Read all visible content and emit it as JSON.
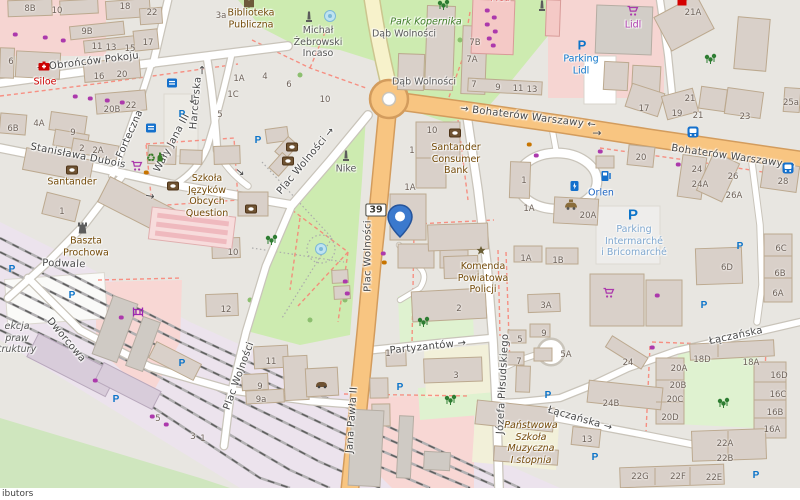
{
  "map": {
    "attribution": "ibutors",
    "shield": {
      "t": "39",
      "x": 376,
      "y": 210
    },
    "marker": {
      "x": 400,
      "y": 238
    },
    "colors": {
      "road_secondary": "#F8C581",
      "road_tertiary": "#F7F2CB",
      "park": "#CDEBB0",
      "grass": "#DFF2D0",
      "retail": "#F6D5D2",
      "railway_land": "#ECE3ED",
      "marker_blue": "#3B79CD",
      "parking_blue": "#0C74C9",
      "shop_purple": "#AC39AC",
      "amenity_brown": "#734A08",
      "school_yellow": "#F2F0D9"
    },
    "streets": [
      {
        "t": "→  Obrońców Pokoju",
        "x": 88,
        "y": 62,
        "r": -7
      },
      {
        "t": "Harcerska",
        "x": 196,
        "y": 103,
        "r": -85
      },
      {
        "t": "Forteczna",
        "x": 130,
        "y": 134,
        "r": -66
      },
      {
        "t": "Wały Jana III",
        "x": 172,
        "y": 143,
        "r": -62
      },
      {
        "t": "Stanisława Dubois",
        "x": 78,
        "y": 156,
        "r": 11
      },
      {
        "t": "Plac Wolności  →",
        "x": 306,
        "y": 161,
        "r": -50
      },
      {
        "t": "Plac Wolności",
        "x": 368,
        "y": 256,
        "r": -90
      },
      {
        "t": "Plac Wolności",
        "x": 239,
        "y": 376,
        "r": -70
      },
      {
        "t": "Jana Pawła II",
        "x": 352,
        "y": 420,
        "r": -86
      },
      {
        "t": "Józefa Piłsudskiego",
        "x": 503,
        "y": 384,
        "r": -87
      },
      {
        "t": "→ Bohaterów Warszawy ←",
        "x": 528,
        "y": 117,
        "r": 7
      },
      {
        "t": "Bohaterów Warszawy →",
        "x": 733,
        "y": 157,
        "r": 8
      },
      {
        "t": "Partyzantów →",
        "x": 428,
        "y": 347,
        "r": -6
      },
      {
        "t": "Łączańska",
        "x": 736,
        "y": 336,
        "r": -12
      },
      {
        "t": "Łączańska →",
        "x": 580,
        "y": 419,
        "r": 16
      },
      {
        "t": "Podwale",
        "x": 64,
        "y": 264,
        "r": 2
      },
      {
        "t": "Dworcowa",
        "x": 66,
        "y": 340,
        "r": 50
      }
    ],
    "pois": [
      {
        "t": "Biblioteka\nPubliczna",
        "x": 251,
        "y": 19,
        "c": "amenity"
      },
      {
        "t": "Michał\nŻebrowski\nIncaso",
        "x": 318,
        "y": 42,
        "c": "gray"
      },
      {
        "t": "Park Kopernika",
        "x": 426,
        "y": 22,
        "c": "park",
        "i": 1
      },
      {
        "t": "Dąb Wolności",
        "x": 404,
        "y": 34,
        "c": "gray"
      },
      {
        "t": "Dąb Wolności",
        "x": 424,
        "y": 82,
        "c": "gray"
      },
      {
        "t": "Lidl",
        "x": 633,
        "y": 25,
        "c": "shop"
      },
      {
        "t": "Parking\nLidl",
        "x": 581,
        "y": 65,
        "c": "parking"
      },
      {
        "t": "Santander\nConsumer\nBank",
        "x": 456,
        "y": 159,
        "c": "amenity"
      },
      {
        "t": "Orlen",
        "x": 601,
        "y": 193,
        "c": "fuel"
      },
      {
        "t": "Parking\nIntermarché\ni Bricomarché",
        "x": 634,
        "y": 241,
        "c": "parking-lt"
      },
      {
        "t": "Komenda\nPowiatowa\nPolicji",
        "x": 483,
        "y": 278,
        "c": "amenity"
      },
      {
        "t": "Szkoła\nJęzyków\nObcych\nQuestion",
        "x": 207,
        "y": 196,
        "c": "amenity"
      },
      {
        "t": "Santander",
        "x": 72,
        "y": 182,
        "c": "amenity"
      },
      {
        "t": "Siloe",
        "x": 45,
        "y": 82,
        "c": "red"
      },
      {
        "t": "Baszta\nProchowa",
        "x": 86,
        "y": 247,
        "c": "amenity"
      },
      {
        "t": "Nike",
        "x": 346,
        "y": 169,
        "c": "gray"
      },
      {
        "t": "Państwowa\nSzkoła\nMuzyczna\nI stopnia",
        "x": 531,
        "y": 443,
        "c": "amenity",
        "i": 1
      },
      {
        "t": "ekcja\npraw\ntruktury",
        "x": 17,
        "y": 338,
        "c": "gray",
        "i": 1
      },
      {
        "t": "Med",
        "x": 500,
        "y": -2,
        "c": "red"
      }
    ],
    "house_numbers": [
      [
        "8B",
        30,
        9
      ],
      [
        "10",
        57,
        11
      ],
      [
        "18",
        125,
        7
      ],
      [
        "22",
        152,
        13
      ],
      [
        "9B",
        87,
        32
      ],
      [
        "11",
        97,
        47
      ],
      [
        "13",
        111,
        48
      ],
      [
        "15",
        130,
        49
      ],
      [
        "17",
        148,
        43
      ],
      [
        "6",
        11,
        62
      ],
      [
        "16",
        99,
        77
      ],
      [
        "20",
        122,
        75
      ],
      [
        "20B",
        112,
        110
      ],
      [
        "22",
        131,
        106
      ],
      [
        "4A",
        39,
        124
      ],
      [
        "6B",
        13,
        129
      ],
      [
        "9",
        73,
        133
      ],
      [
        "2",
        82,
        149
      ],
      [
        "2A",
        98,
        151
      ],
      [
        "3a",
        221,
        16
      ],
      [
        "1A",
        239,
        79
      ],
      [
        "1C",
        233,
        95
      ],
      [
        "4",
        265,
        77
      ],
      [
        "6",
        289,
        85
      ],
      [
        "5",
        220,
        115
      ],
      [
        "10",
        325,
        100
      ],
      [
        "7B",
        475,
        43
      ],
      [
        "7A",
        472,
        60
      ],
      [
        "7",
        474,
        85
      ],
      [
        "9",
        498,
        88
      ],
      [
        "11",
        518,
        89
      ],
      [
        "13",
        532,
        90
      ],
      [
        "10",
        432,
        131
      ],
      [
        "1",
        412,
        151
      ],
      [
        "1A",
        410,
        188
      ],
      [
        "21A",
        693,
        13
      ],
      [
        "17",
        644,
        109
      ],
      [
        "19",
        677,
        114
      ],
      [
        "21",
        690,
        99
      ],
      [
        "21",
        698,
        116
      ],
      [
        "23",
        745,
        117
      ],
      [
        "25a",
        791,
        103
      ],
      [
        "20",
        641,
        158
      ],
      [
        "24",
        697,
        170
      ],
      [
        "24A",
        700,
        185
      ],
      [
        "26",
        733,
        177
      ],
      [
        "26A",
        734,
        196
      ],
      [
        "28",
        783,
        182
      ],
      [
        "1",
        524,
        181
      ],
      [
        "1A",
        529,
        209
      ],
      [
        "20A",
        588,
        216
      ],
      [
        "6C",
        781,
        249
      ],
      [
        "6D",
        727,
        268
      ],
      [
        "6B",
        780,
        274
      ],
      [
        "6A",
        778,
        294
      ],
      [
        "1A",
        526,
        259
      ],
      [
        "1B",
        558,
        261
      ],
      [
        "3A",
        546,
        306
      ],
      [
        "1",
        62,
        212
      ],
      [
        "10",
        233,
        253
      ],
      [
        "12",
        226,
        310
      ],
      [
        "11",
        271,
        362
      ],
      [
        "9",
        260,
        387
      ],
      [
        "9a",
        261,
        400
      ],
      [
        "2",
        459,
        309
      ],
      [
        "3",
        456,
        376
      ],
      [
        "1",
        388,
        354
      ],
      [
        "9",
        544,
        334
      ],
      [
        "5",
        520,
        340
      ],
      [
        "7",
        519,
        362
      ],
      [
        "5A",
        566,
        355
      ],
      [
        "5",
        158,
        419
      ],
      [
        "3",
        193,
        437
      ],
      [
        "1",
        203,
        439
      ],
      [
        "24",
        628,
        363
      ],
      [
        "24B",
        611,
        404
      ],
      [
        "13",
        587,
        440
      ],
      [
        "18D",
        702,
        360
      ],
      [
        "18A",
        751,
        363
      ],
      [
        "20A",
        679,
        369
      ],
      [
        "20B",
        678,
        386
      ],
      [
        "20C",
        675,
        400
      ],
      [
        "20D",
        670,
        418
      ],
      [
        "16D",
        779,
        376
      ],
      [
        "16C",
        778,
        395
      ],
      [
        "16B",
        775,
        413
      ],
      [
        "16A",
        772,
        430
      ],
      [
        "22A",
        725,
        444
      ],
      [
        "22B",
        725,
        459
      ],
      [
        "22G",
        640,
        477
      ],
      [
        "22F",
        678,
        477
      ],
      [
        "22E",
        714,
        478
      ]
    ],
    "icons": [
      [
        "parking-icon",
        182,
        115
      ],
      [
        "parking-icon",
        258,
        141
      ],
      [
        "parking-icon",
        582,
        45,
        13
      ],
      [
        "parking-icon",
        12,
        270
      ],
      [
        "parking-icon",
        72,
        296
      ],
      [
        "parking-icon",
        116,
        400
      ],
      [
        "parking-icon",
        182,
        364
      ],
      [
        "parking-icon",
        633,
        215,
        15
      ],
      [
        "parking-icon",
        740,
        247
      ],
      [
        "parking-icon",
        704,
        306
      ],
      [
        "parking-icon",
        400,
        388
      ],
      [
        "parking-icon",
        548,
        396
      ],
      [
        "parking-icon",
        595,
        458
      ],
      [
        "parking-icon",
        756,
        476
      ],
      [
        "bank-icon",
        72,
        170
      ],
      [
        "bank-icon",
        292,
        147
      ],
      [
        "bank-icon",
        288,
        161
      ],
      [
        "bank-icon",
        251,
        209
      ],
      [
        "bank-icon",
        455,
        133
      ],
      [
        "bank-icon",
        173,
        186
      ],
      [
        "cart-icon",
        633,
        11
      ],
      [
        "cart-icon",
        609,
        293
      ],
      [
        "cart-icon",
        137,
        166
      ],
      [
        "fuel-icon",
        606,
        176
      ],
      [
        "charging-icon",
        575,
        186
      ],
      [
        "taxi-icon",
        571,
        205
      ],
      [
        "bus-icon",
        693,
        132
      ],
      [
        "bus-icon",
        788,
        168
      ],
      [
        "police-icon",
        481,
        251
      ],
      [
        "library-icon",
        249,
        4
      ],
      [
        "castle-icon",
        82,
        228
      ],
      [
        "pharmacy-icon",
        44,
        66
      ],
      [
        "monument-icon",
        309,
        17
      ],
      [
        "monument-icon",
        346,
        156
      ],
      [
        "monument-icon",
        542,
        6
      ],
      [
        "tree-icon",
        444,
        5
      ],
      [
        "tree-icon",
        711,
        59
      ],
      [
        "tree-icon",
        424,
        322
      ],
      [
        "tree-icon",
        451,
        400
      ],
      [
        "tree-icon",
        724,
        403
      ],
      [
        "tree-icon",
        272,
        240
      ],
      [
        "fountain-icon",
        321,
        249
      ],
      [
        "fountain-icon",
        330,
        16
      ],
      [
        "recycle-icon",
        151,
        158
      ],
      [
        "bottle-icon",
        160,
        157
      ],
      [
        "shelter-icon",
        172,
        83
      ],
      [
        "shelter-icon",
        151,
        128
      ],
      [
        "gate-icon",
        138,
        312
      ],
      [
        "carshop-icon",
        322,
        384
      ],
      [
        "red-poi-icon",
        682,
        2
      ],
      [
        "arrow-icon",
        597,
        133,
        0
      ],
      [
        "arrow-icon",
        202,
        70,
        -90
      ],
      [
        "arrow-icon",
        150,
        196,
        10
      ],
      [
        "arrow-icon",
        240,
        172,
        40
      ],
      [
        "arrow-icon",
        192,
        99,
        90
      ],
      [
        "shop-dot",
        15,
        34
      ],
      [
        "shop-dot",
        45,
        37
      ],
      [
        "shop-dot",
        63,
        40
      ],
      [
        "shop-dot",
        75,
        96
      ],
      [
        "shop-dot",
        90,
        98
      ],
      [
        "shop-dot",
        107,
        100
      ],
      [
        "shop-dot",
        122,
        102
      ],
      [
        "shop-dot",
        487,
        10
      ],
      [
        "shop-dot",
        494,
        17
      ],
      [
        "shop-dot",
        487,
        24
      ],
      [
        "shop-dot",
        495,
        31
      ],
      [
        "shop-dot",
        489,
        38
      ],
      [
        "shop-dot",
        493,
        45
      ],
      [
        "shop-dot",
        600,
        151
      ],
      [
        "shop-dot",
        678,
        164
      ],
      [
        "shop-dot",
        345,
        281
      ],
      [
        "shop-dot",
        347,
        293
      ],
      [
        "shop-dot",
        152,
        416
      ],
      [
        "shop-dot",
        166,
        424
      ],
      [
        "shop-dot",
        383,
        253
      ],
      [
        "shop-dot",
        657,
        295
      ],
      [
        "shop-dot",
        536,
        155
      ],
      [
        "shop-dot",
        652,
        347
      ],
      [
        "shop-dot",
        95,
        380
      ],
      [
        "shop-dot",
        121,
        317
      ],
      [
        "food-dot",
        384,
        262
      ],
      [
        "food-dot",
        529,
        144
      ],
      [
        "food-dot",
        146,
        172
      ]
    ]
  }
}
